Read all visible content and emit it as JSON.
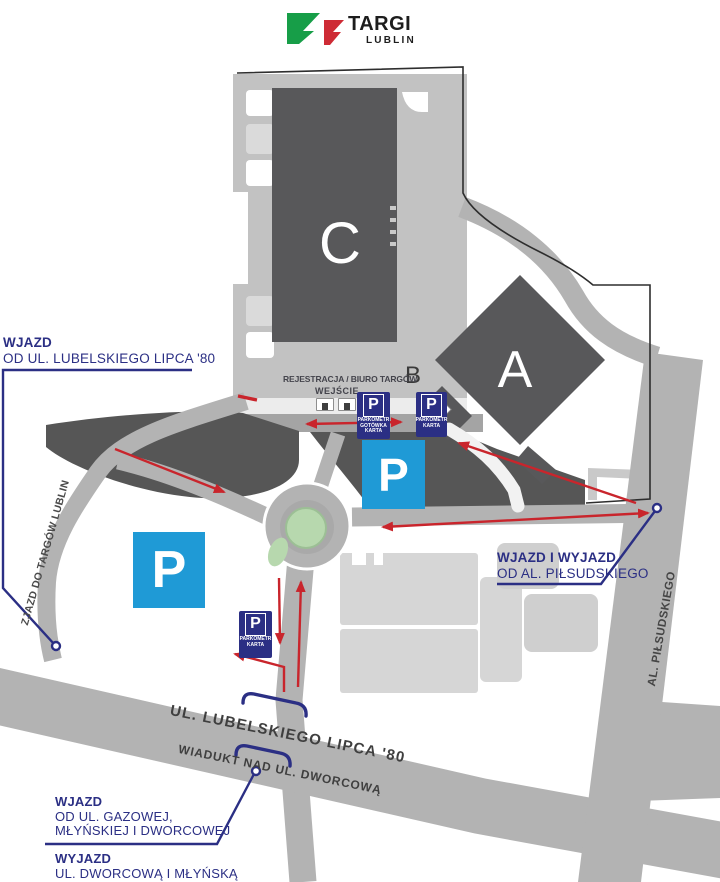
{
  "logo": {
    "title": "TARGI",
    "subtitle": "LUBLIN"
  },
  "halls": {
    "a": "A",
    "b": "B",
    "c": "C"
  },
  "registration": {
    "line1": "REJESTRACJA / BIURO TARGÓW",
    "line2": "WEJŚCIE"
  },
  "parking": {
    "big_p": "P",
    "sign_meter_cash": {
      "letter": "P",
      "lines": [
        "PARKOMETR",
        "GOTÓWKA",
        "KARTA"
      ]
    },
    "sign_meter_card": {
      "letter": "P",
      "lines": [
        "PARKOMETR",
        "KARTA"
      ]
    }
  },
  "annotations": {
    "entry_top_left": {
      "title": "WJAZD",
      "subtitle": "OD UL. LUBELSKIEGO LIPCA '80"
    },
    "ramp_label": "ZJAZD DO TARGÓW LUBLIN",
    "entry_exit_right": {
      "title": "WJAZD I WYJAZD",
      "subtitle": "OD AL. PIŁSUDSKIEGO"
    },
    "entry_bottom": {
      "title": "WJAZD",
      "line2": "OD UL. GAZOWEJ,",
      "line3": "MŁYŃSKIEJ I DWORCOWEJ"
    },
    "exit_bottom": {
      "title": "WYJAZD",
      "line2": "UL. DWORCOWĄ I MŁYŃSKĄ"
    }
  },
  "streets": {
    "lipca": "UL. LUBELSKIEGO LIPCA '80",
    "viaduct": "WIADUKT NAD UL. DWORCOWĄ",
    "pilsudskiego": "AL. PIŁSUDSKIEGO"
  },
  "icons": {
    "entrance_door": "door-icon",
    "location_marker": "circle-marker",
    "viaduct_bracket": "viaduct-bracket",
    "direction_arrow": "red-arrow"
  },
  "colors": {
    "navy": "#2b2f84",
    "arrow_red": "#c9252c",
    "parking_blue": "#1f9ad6",
    "building_dark": "#58585a",
    "parking_dark": "#565656",
    "road_gray": "#b3b3b3",
    "yard_gray": "#c2c2c2",
    "island_green": "#b7d8ae",
    "logo_green": "#179e48",
    "logo_red": "#ce2b35"
  }
}
